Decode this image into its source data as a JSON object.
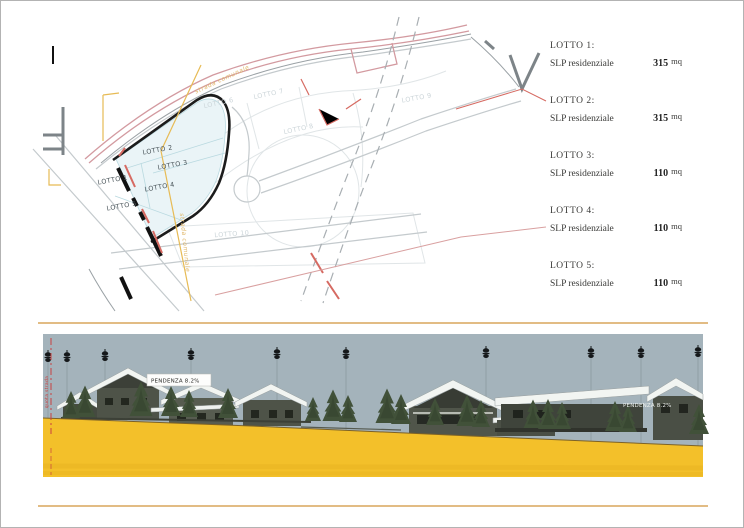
{
  "document": {
    "cursor_mark": ""
  },
  "legend": {
    "entries": [
      {
        "title": "LOTTO 1:",
        "label": "SLP residenziale",
        "value": "315",
        "unit": "mq"
      },
      {
        "title": "LOTTO 2:",
        "label": "SLP residenziale",
        "value": "315",
        "unit": "mq"
      },
      {
        "title": "LOTTO 3:",
        "label": "SLP residenziale",
        "value": "110",
        "unit": "mq"
      },
      {
        "title": "LOTTO 4:",
        "label": "SLP residenziale",
        "value": "110",
        "unit": "mq"
      },
      {
        "title": "LOTTO 5:",
        "label": "SLP residenziale",
        "value": "110",
        "unit": "mq"
      }
    ]
  },
  "plan": {
    "lot_labels": [
      {
        "text": "LOTTO 1"
      },
      {
        "text": "LOTTO 2"
      },
      {
        "text": "LOTTO 3"
      },
      {
        "text": "LOTTO 4"
      },
      {
        "text": "LOTTO 5"
      },
      {
        "text": "LOTTO 6"
      },
      {
        "text": "LOTTO 7"
      },
      {
        "text": "LOTTO 8"
      },
      {
        "text": "LOTTO 9"
      },
      {
        "text": "LOTTO 10"
      }
    ],
    "road_labels": [
      {
        "text": "strada comunale"
      },
      {
        "text": "strada comunale"
      }
    ]
  },
  "elevation": {
    "slope_label_left": "PENDENZA 8.2%",
    "slope_label_right": "PENDENZA 8.2%",
    "datum_label": "quota strada"
  },
  "colors": {
    "boundary_black": "#1c1c1c",
    "lot_fill": "#eaf4f7",
    "lot_stroke": "#b9d9e0",
    "road_pink": "#d39aa0",
    "accent_orange": "#e7bb55",
    "dash_red": "#d66a62",
    "sky": "#a4b3bb",
    "ground_yellow": "#f3c02a",
    "roof_white": "#f2f5f2",
    "tree_green": "#415139",
    "frame_tan": "#d8a55c"
  }
}
